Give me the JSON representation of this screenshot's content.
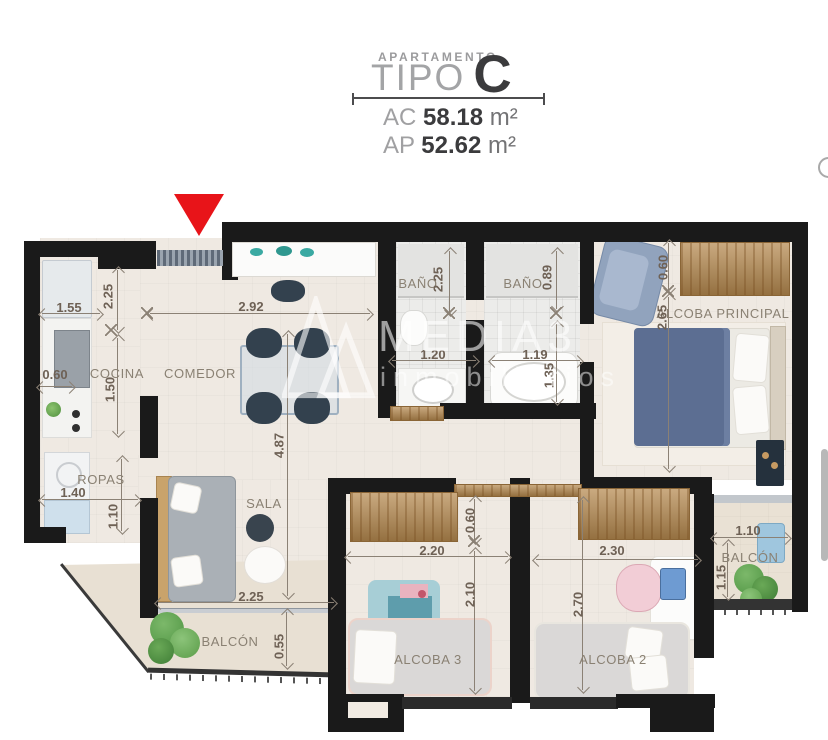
{
  "header": {
    "category": "APARTAMENTO",
    "type_word": "TIPO",
    "type_letter": "C",
    "areas": [
      {
        "label": "AC",
        "value": "58.18",
        "unit": "m²"
      },
      {
        "label": "AP",
        "value": "52.62",
        "unit": "m²"
      }
    ]
  },
  "watermark": {
    "brand": "MEDIA3",
    "tagline": "inmobiliarios"
  },
  "rooms": {
    "cocina": "COCINA",
    "comedor": "COMEDOR",
    "bano_1": "BAÑO",
    "bano_2": "BAÑO",
    "alcoba_principal": "ALCOBA PRINCIPAL",
    "ropas": "ROPAS",
    "sala": "SALA",
    "balcon_izq": "BALCÓN",
    "alcoba_3": "ALCOBA 3",
    "alcoba_2": "ALCOBA 2",
    "balcon_der": "BALCÓN"
  },
  "dims": {
    "cocina_ancho": "1.55",
    "entrada": "2.25",
    "cocina_fondo": "0.60",
    "cocina_alto": "1.50",
    "comedor_ancho": "2.92",
    "sala_largo": "4.87",
    "sala_ancho": "2.25",
    "balcon_izq_fondo": "0.55",
    "ropas_ancho": "1.40",
    "ropas_alto": "1.10",
    "bano1_alto": "2.25",
    "bano1_ancho": "1.20",
    "bano2_alto": "0.89",
    "bano2_ancho": "1.19",
    "bano2_fondo": "1.35",
    "ppal_closet": "0.60",
    "ppal_alto": "2.65",
    "alc3_closet": "0.60",
    "alc3_ancho": "2.20",
    "alc3_alto": "2.10",
    "alc2_ancho": "2.30",
    "alc2_alto": "2.70",
    "balcon_der_ancho": "1.10",
    "balcon_der_fondo": "1.15"
  },
  "colors": {
    "accent_red": "#e81419",
    "wall": "#1a1a1a",
    "wood": "#b5894f"
  }
}
